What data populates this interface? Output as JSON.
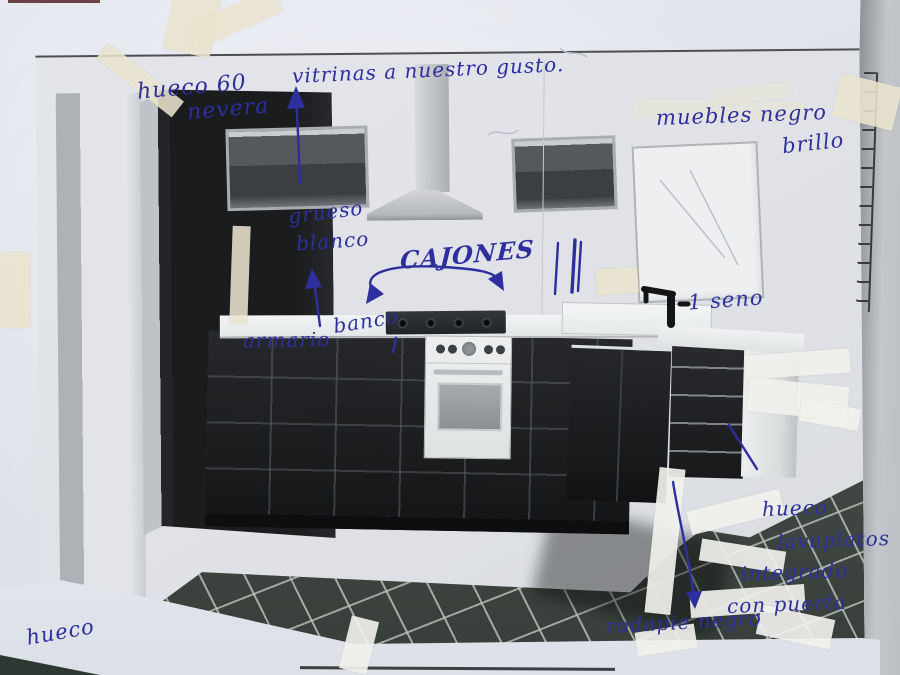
{
  "annotations": {
    "hueco_nevera_line1": "hueco 60",
    "hueco_nevera_line2": "nevera",
    "vitrinas": "vitrinas a nuestro gusto.",
    "muebles_line1": "muebles negro",
    "muebles_line2": "brillo",
    "grueso_line1": "grueso",
    "grueso_line2": "blanco",
    "cajones": "CAJONES",
    "armario_word1": "armario",
    "armario_word2": "banco",
    "seno": "1 seno",
    "lavaplatos_line1": "hueco",
    "lavaplatos_line2": "lavaplatos",
    "lavaplatos_line3": "integrado",
    "lavaplatos_line4": "con puerta",
    "rodapie": "rodapie negro",
    "hueco_corner": "hueco"
  },
  "colors": {
    "ink": "#2e2f9e",
    "tape": "#e9e4ce",
    "cabinet_black": "#1c1e20",
    "floor_tile": "#3b423d",
    "paper": "#e2e5ec"
  }
}
